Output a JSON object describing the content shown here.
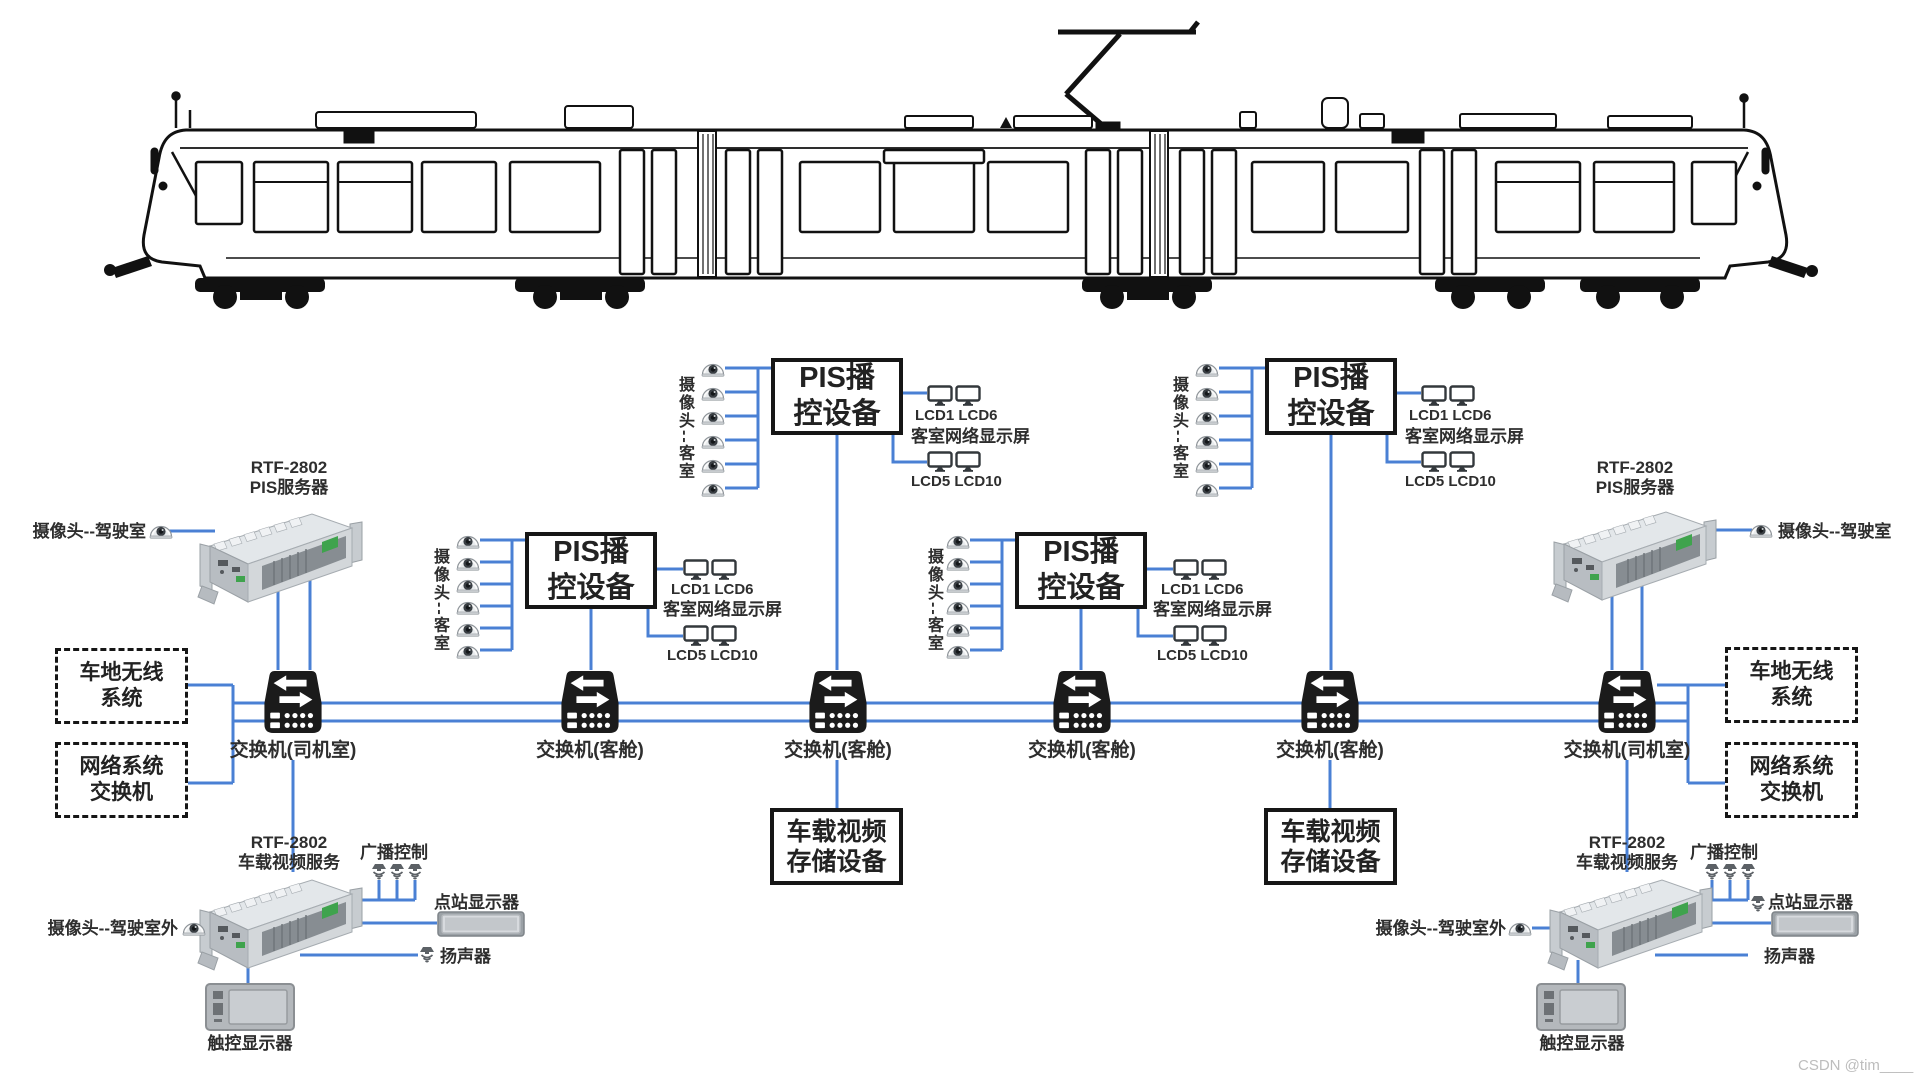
{
  "colors": {
    "wire_blue": "#4a80d4",
    "device_black": "#1b1b1b",
    "text_dark": "#2e2e2e",
    "watermark_gray": "#bdbdbd"
  },
  "watermark": "CSDN @tim____",
  "left": {
    "pis_server": {
      "model": "RTF-2802",
      "name": "PIS服务器"
    },
    "cab_camera": "摄像头--驾驶室",
    "wireless_box": {
      "line1": "车地无线",
      "line2": "系统"
    },
    "network_box": {
      "line1": "网络系统",
      "line2": "交换机"
    },
    "video_server": {
      "model": "RTF-2802",
      "name": "车载视频服务"
    },
    "broadcast": "广播控制",
    "station_display": "点站显示器",
    "speaker": "扬声器",
    "touch_display": "触控显示器",
    "outside_camera": "摄像头--驾驶室外"
  },
  "right": {
    "pis_server": {
      "model": "RTF-2802",
      "name": "PIS服务器"
    },
    "cab_camera": "摄像头--驾驶室",
    "wireless_box": {
      "line1": "车地无线",
      "line2": "系统"
    },
    "network_box": {
      "line1": "网络系统",
      "line2": "交换机"
    },
    "video_server": {
      "model": "RTF-2802",
      "name": "车载视频服务"
    },
    "broadcast": "广播控制",
    "station_display": "点站显示器",
    "speaker": "扬声器",
    "touch_display": "触控显示器",
    "outside_camera": "摄像头--驾驶室外"
  },
  "switches": [
    {
      "label": "交换机(司机室)"
    },
    {
      "label": "交换机(客舱)"
    },
    {
      "label": "交换机(客舱)"
    },
    {
      "label": "交换机(客舱)"
    },
    {
      "label": "交换机(客舱)"
    },
    {
      "label": "交换机(司机室)"
    }
  ],
  "pis_groups": [
    {
      "camera_label": "摄像头--客室",
      "box_line1": "PIS播",
      "box_line2": "控设备",
      "lcd_top": "LCD1 LCD6",
      "screen": "客室网络显示屏",
      "lcd_bottom": "LCD5 LCD10"
    },
    {
      "camera_label": "摄像头--客室",
      "box_line1": "PIS播",
      "box_line2": "控设备",
      "lcd_top": "LCD1 LCD6",
      "screen": "客室网络显示屏",
      "lcd_bottom": "LCD5 LCD10"
    },
    {
      "camera_label": "摄像头--客室",
      "box_line1": "PIS播",
      "box_line2": "控设备",
      "lcd_top": "LCD1 LCD6",
      "screen": "客室网络显示屏",
      "lcd_bottom": "LCD5 LCD10"
    },
    {
      "camera_label": "摄像头--客室",
      "box_line1": "PIS播",
      "box_line2": "控设备",
      "lcd_top": "LCD1 LCD6",
      "screen": "客室网络显示屏",
      "lcd_bottom": "LCD5 LCD10"
    }
  ],
  "storage_units": [
    {
      "line1": "车载视频",
      "line2": "存储设备"
    },
    {
      "line1": "车载视频",
      "line2": "存储设备"
    }
  ]
}
